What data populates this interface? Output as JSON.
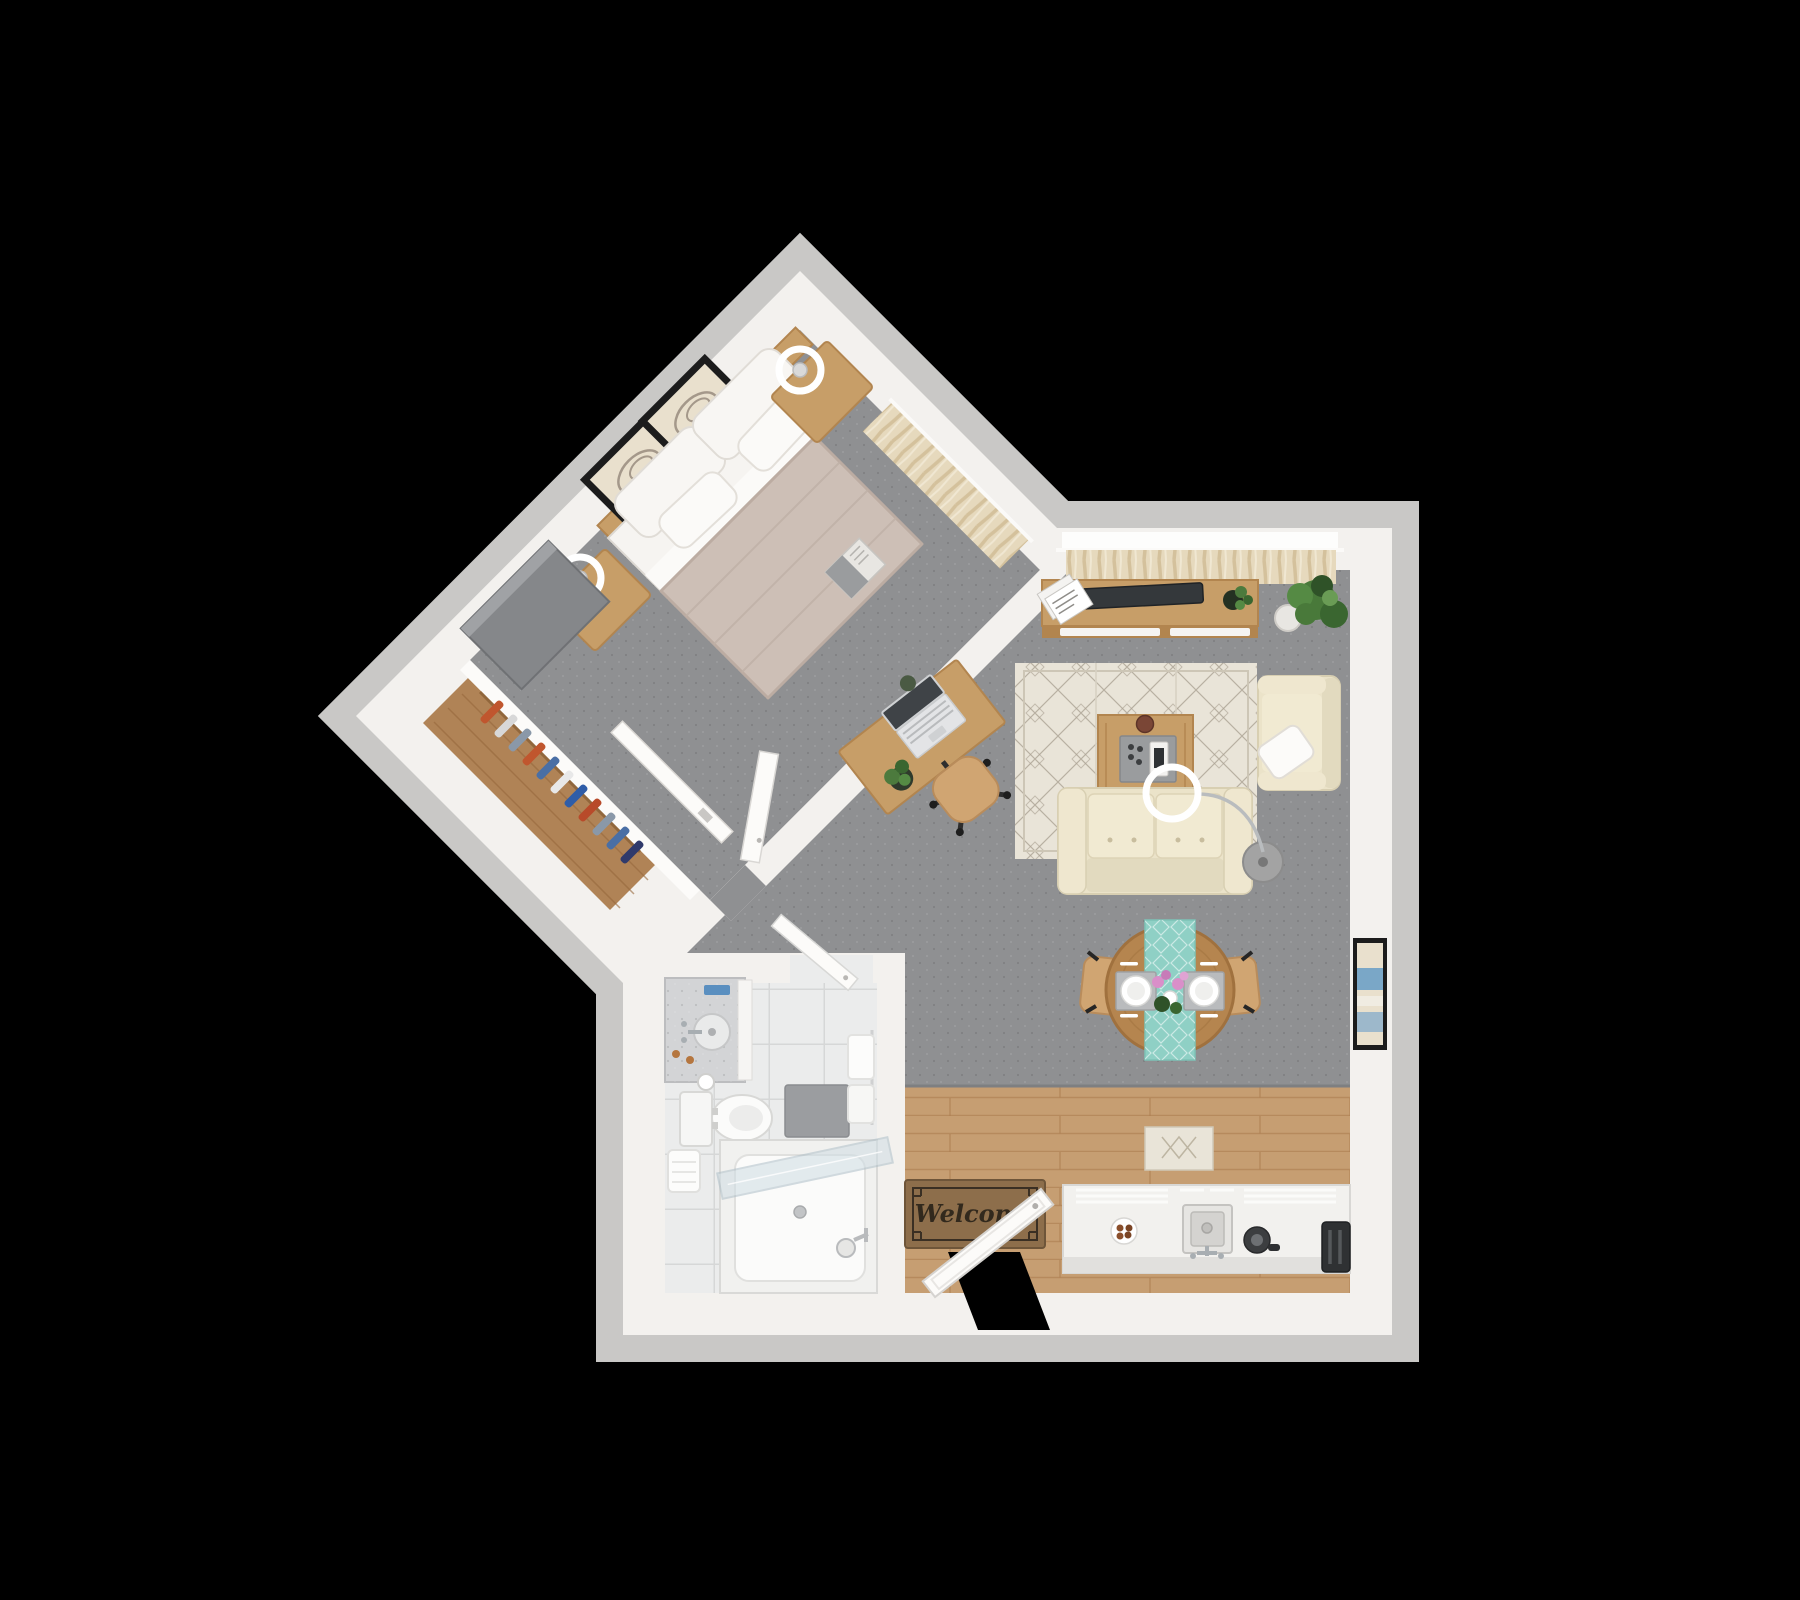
{
  "meta": {
    "title": "3D floor plan render — one-bedroom apartment, top-down view",
    "canvas": {
      "width": 1800,
      "height": 1600
    },
    "view": "top-down 3D dollhouse render",
    "background_note": "apartment floats on a solid black background; bedroom wing rotated 45 degrees"
  },
  "palette": {
    "background": "#000000",
    "wall": "#f3f1ee",
    "wall_fringe": "#c9c8c6",
    "carpet": "#8f9092",
    "wood_floor": "#c69e72",
    "wood_line": "#b08052",
    "closet_wood": "#b08356",
    "furniture_wood": "#c79e68",
    "furniture_wood_dark": "#b2854f",
    "dining_wood": "#b5854f",
    "chair_wood": "#d0a572",
    "rug": "#e9e4d8",
    "rug_line": "#a89f90",
    "sofa": "#ebe3c9",
    "cushion": "#f1ead2",
    "duvet": "#cdbfb6",
    "linen": "#f6f4f1",
    "teal_runner": "#8fd0c5",
    "tv_dark": "#34383b",
    "plant_green": "#4c7a3d",
    "plant_dark": "#2f5228",
    "mat_brown": "#8d6e4b",
    "mat_ink": "#32291d",
    "tile": "#ebecec",
    "glass": "#cfdde4",
    "chrome": "#a8aeb2",
    "lamp_base": "#a3a3a3",
    "frame_dark": "#1c1c1c",
    "art_beige": "#e9e0cd",
    "art_blue": "#7aa7c7",
    "gray_furniture": "#85878a",
    "door_white": "#fcfbf9",
    "granite": "#d3d4d6"
  },
  "entry": {
    "mat_text": "Welcome",
    "items": [
      "welcome-doormat",
      "open-entry-door",
      "doorway-gap"
    ]
  },
  "rooms": {
    "bedroom": {
      "name": "Bedroom",
      "floor": "gray carpet",
      "rotation_deg": 45,
      "items": [
        "double-bed-taupe-duvet",
        "four-white-pillows",
        "wood-headboard",
        "framed-art-x2",
        "nightstand-x2",
        "round-table-lamp-x2",
        "gray-dresser",
        "open-book-on-bed",
        "window-beige-curtains",
        "open-bedroom-door"
      ]
    },
    "closet": {
      "name": "Closet corridor",
      "floor": "wood",
      "items": [
        "hanging-clothes",
        "sliding-door-panel"
      ]
    },
    "living_room": {
      "name": "Living room",
      "floor": "gray carpet",
      "items": [
        "media-console",
        "flat-tv-on-console",
        "magazine-stack",
        "console-plant",
        "large-floor-plant",
        "window-beige-curtains",
        "patterned-area-rug",
        "coffee-table-with-tray-and-mug",
        "cream-loveseat-sofa",
        "arc-floor-lamp",
        "cream-armchair-with-pillow",
        "desk-with-laptop-and-plant",
        "office-chair",
        "wall-art-east-wall"
      ]
    },
    "dining": {
      "name": "Dining nook",
      "floor": "gray carpet",
      "items": [
        "round-dining-table",
        "teal-table-runner",
        "place-setting-x2",
        "pink-flower-centerpiece",
        "wood-dining-chair-x2"
      ]
    },
    "kitchen": {
      "name": "Kitchen",
      "floor": "wood planks",
      "items": [
        "white-counter-cabinets",
        "plate-of-cookies",
        "square-sink-with-faucet",
        "kettle",
        "toaster",
        "small-cream-rug"
      ]
    },
    "bathroom": {
      "name": "Bathroom",
      "floor": "white tile",
      "items": [
        "granite-vanity-round-sink",
        "faucet",
        "toiletries",
        "toilet",
        "toilet-paper-roll",
        "hanging-towels",
        "gray-bath-mat",
        "bathtub-shower",
        "glass-shower-door",
        "open-bathroom-door"
      ]
    }
  }
}
